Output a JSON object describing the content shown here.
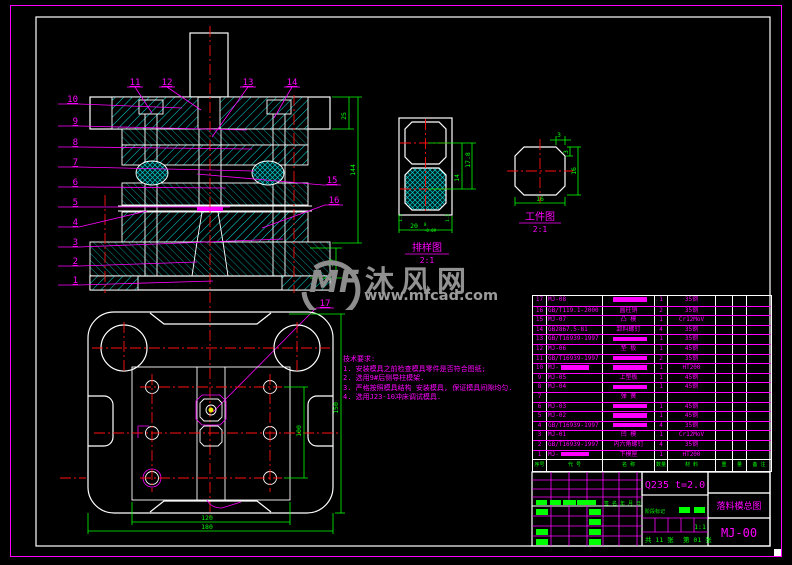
{
  "watermark": {
    "logo": "MF",
    "site_name": "沐风网",
    "url": "www.mfcad.com"
  },
  "tech_requirements": {
    "title": "技术要求:",
    "items": [
      "1. 安装模具之前检查模具零件是否符合图纸;",
      "2. 选用9#后侧导柱模架.",
      "3. 严格按照模具结构 安装模具, 保证模具间隙均匀.",
      "4. 选用J23-10冲床调试模具."
    ]
  },
  "callouts": [
    "1",
    "2",
    "3",
    "4",
    "5",
    "6",
    "7",
    "8",
    "9",
    "10",
    "11",
    "12",
    "13",
    "14",
    "15",
    "16",
    "17"
  ],
  "views": {
    "assembly": {
      "dims": {
        "top_plate_thickness": "25",
        "closed_height": "144",
        "base_height": "30"
      }
    },
    "strip_layout": {
      "label": "排样图",
      "scale": "2:1",
      "dims": {
        "pitch": "17.8",
        "step": "14",
        "width": "20",
        "tol_upper": "0",
        "tol_lower": "-0.09",
        "margin_left": "1.5",
        "margin_right": "1.5"
      }
    },
    "workpiece": {
      "label": "工件图",
      "scale": "2:1",
      "dims": {
        "width": "16",
        "height": "16",
        "chamfer_top": "3",
        "chamfer_side": "3"
      }
    },
    "plan": {
      "dims": {
        "inner_width": "120",
        "outer_width": "180",
        "inner_height": "100",
        "outer_height": "150"
      }
    }
  },
  "bom": {
    "headers": {
      "no": "序号",
      "code": "代 号",
      "name": "名 称",
      "qty": "数量",
      "material": "材 料",
      "weight_unit": "重",
      "weight_total": "量",
      "note": "备 注"
    },
    "rows": [
      {
        "no": "17",
        "code": "MJ-08",
        "name": "",
        "name_block": true,
        "qty": "1",
        "material": "35钢"
      },
      {
        "no": "16",
        "code": "GB/T119.1-2000",
        "name": "圆柱销",
        "name_block": false,
        "qty": "2",
        "material": "35钢"
      },
      {
        "no": "15",
        "code": "MJ-07",
        "name": "凸 模",
        "name_block": false,
        "qty": "1",
        "material": "Cr12MoV"
      },
      {
        "no": "14",
        "code": "GB2867.5-81",
        "name": "卸料螺钉",
        "name_block": false,
        "qty": "4",
        "material": "35钢"
      },
      {
        "no": "13",
        "code": "GB/T16939-1997",
        "name": "",
        "name_block": true,
        "qty": "1",
        "material": "35钢"
      },
      {
        "no": "12",
        "code": "MJ-06",
        "name": "垫 板",
        "name_block": false,
        "qty": "1",
        "material": "45钢"
      },
      {
        "no": "11",
        "code": "GB/T16939-1997",
        "name": "",
        "name_block": true,
        "qty": "2",
        "material": "35钢"
      },
      {
        "no": "10",
        "code": "MJ-",
        "code_block": true,
        "name": "",
        "name_block": true,
        "qty": "1",
        "material": "HT200"
      },
      {
        "no": "9",
        "code": "MJ-05",
        "name": "上垫板",
        "name_block": false,
        "qty": "1",
        "material": "45钢"
      },
      {
        "no": "8",
        "code": "MJ-04",
        "name": "",
        "name_block": true,
        "qty": "1",
        "material": "45钢"
      },
      {
        "no": "7",
        "code": "",
        "name": "弹 簧",
        "name_block": false,
        "qty": "",
        "material": ""
      },
      {
        "no": "6",
        "code": "MJ-03",
        "name": "",
        "name_block": true,
        "qty": "1",
        "material": "45钢"
      },
      {
        "no": "5",
        "code": "MJ-02",
        "name": "",
        "name_block": true,
        "qty": "1",
        "material": "45钢"
      },
      {
        "no": "4",
        "code": "GB/T16939-1997",
        "name": "",
        "name_block": true,
        "qty": "4",
        "material": "35钢"
      },
      {
        "no": "3",
        "code": "MJ-01",
        "name": "凹 模",
        "name_block": false,
        "qty": "1",
        "material": "Cr12MoV"
      },
      {
        "no": "2",
        "code": "GB/T16939-1997",
        "name": "内六角螺钉",
        "name_block": false,
        "qty": "4",
        "material": "35钢"
      },
      {
        "no": "1",
        "code": "MJ-",
        "code_block": true,
        "name": "下模座",
        "name_block": false,
        "qty": "1",
        "material": "HT200"
      }
    ]
  },
  "title_block": {
    "material_spec": "Q235  t=2.0",
    "drawing_title": "落料模总图",
    "drawing_no": "MJ-00",
    "scale": "1:1",
    "stage_label": "阶段标记",
    "sign_label": "签 名",
    "date_label": "年 月 日",
    "sheet_total": "共 11 张",
    "sheet_current": "第 01 张"
  }
}
